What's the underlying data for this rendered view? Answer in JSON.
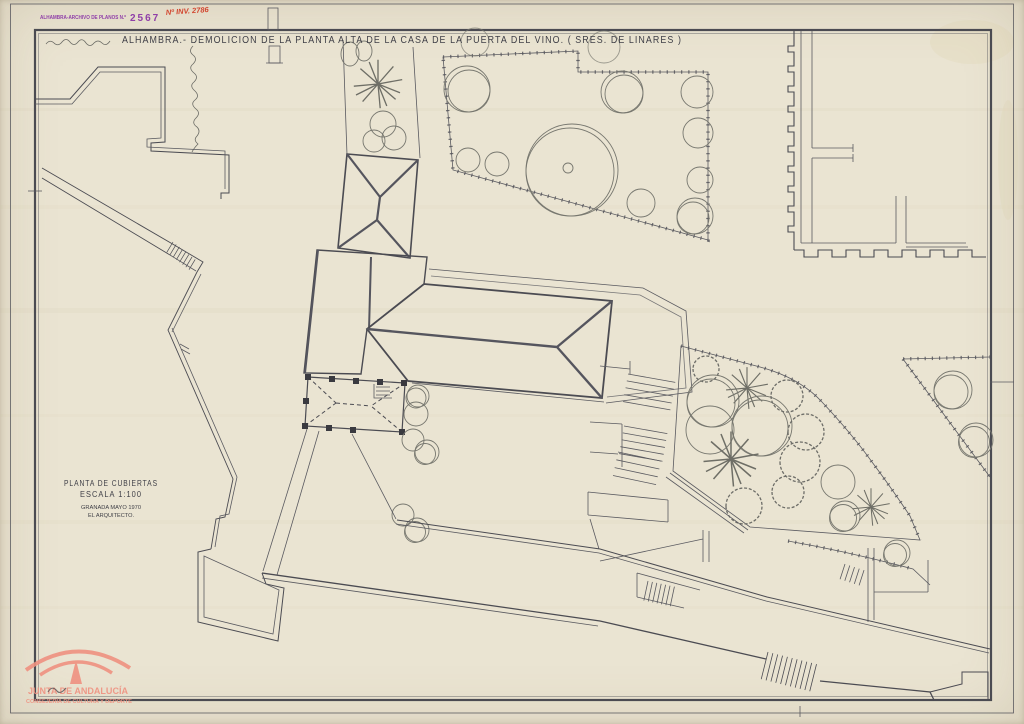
{
  "stamp": {
    "label": "ALHAMBRA-ARCHIVO DE PLANOS N.º",
    "number": "2567",
    "inventory": "Nº INV. 2786"
  },
  "title": "ALHAMBRA.- DEMOLICION DE LA PLANTA ALTA DE LA CASA DE LA PUERTA DEL VINO. ( SRES. DE LINARES )",
  "plan_block": {
    "line1": "PLANTA DE CUBIERTAS",
    "line2": "ESCALA 1:100",
    "line3": "GRANADA MAYO 1970",
    "line4": "EL ARQUITECTO."
  },
  "watermark": {
    "org": "JUNTA DE ANDALUCÍA",
    "department": "CONSEJERÍA DE CULTURA Y DEPORTE"
  },
  "colors": {
    "paper": "#eae4d2",
    "ink": "#4b4b52",
    "hatch": "#7b7b74",
    "stamp_purple": "#8f3fa8",
    "stamp_red": "#d2452e",
    "watermark_salmon": "#ef9180"
  }
}
